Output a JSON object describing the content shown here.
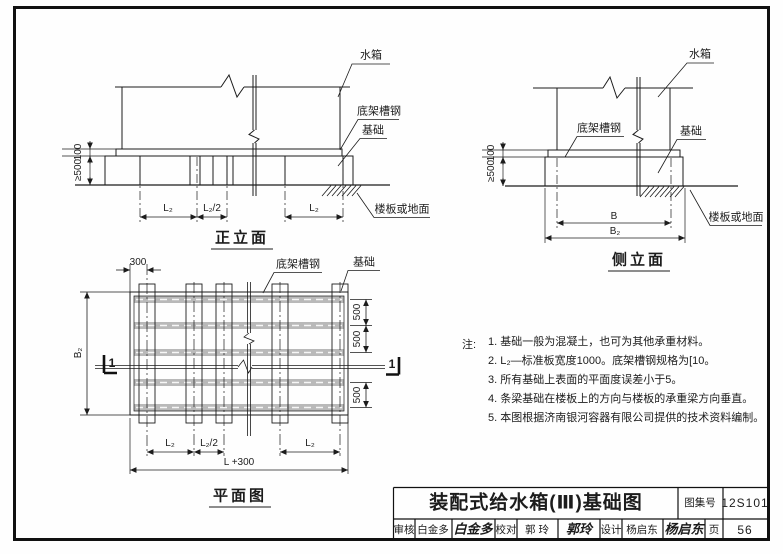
{
  "front_view": {
    "title": "正立面",
    "label_tank": "水箱",
    "label_channel": "底架槽钢",
    "label_foundation": "基础",
    "label_floor": "楼板或地面",
    "dim_100": "100",
    "dim_500": "≥500",
    "dim_l2_left": "L₂",
    "dim_l2_half": "L₂/2",
    "dim_l2_right": "L₂"
  },
  "side_view": {
    "title": "侧立面",
    "label_tank": "水箱",
    "label_channel": "底架槽钢",
    "label_foundation": "基础",
    "label_floor": "楼板或地面",
    "dim_100": "100",
    "dim_500": "≥500",
    "dim_b": "B",
    "dim_b2": "B₂"
  },
  "plan_view": {
    "title": "平面图",
    "label_channel": "底架槽钢",
    "label_foundation": "基础",
    "dim_300": "300",
    "dim_b2": "B₂",
    "dim_500_1": "500",
    "dim_500_2": "500",
    "dim_500_3": "500",
    "dim_l2_left": "L₂",
    "dim_l2_half": "L₂/2",
    "dim_l2_right": "L₂",
    "dim_total": "L +300",
    "section_left": "1",
    "section_right": "1"
  },
  "notes": {
    "heading": "注:",
    "items": [
      "1.  基础一般为混凝土，也可为其他承重材料。",
      "2.  L₂—标准板宽度1000。底架槽钢规格为[10。",
      "3.  所有基础上表面的平面度误差小于5。",
      "4.  条梁基础在楼板上的方向与楼板的承重梁方向垂直。",
      "5.  本图根据济南银河容器有限公司提供的技术资料编制。"
    ]
  },
  "title_block": {
    "title": "装配式给水箱(Ⅲ)基础图",
    "atlas_label": "图集号",
    "atlas_no": "12S101",
    "page_label": "页",
    "page_no": "56",
    "reviewer_label": "审核",
    "reviewer_name": "白金多",
    "reviewer_sig": "白金多",
    "checker_label": "校对",
    "checker_name": "郭 玲",
    "checker_sig": "郭玲",
    "designer_label": "设计",
    "designer_name": "杨启东",
    "designer_sig": "杨启东"
  }
}
